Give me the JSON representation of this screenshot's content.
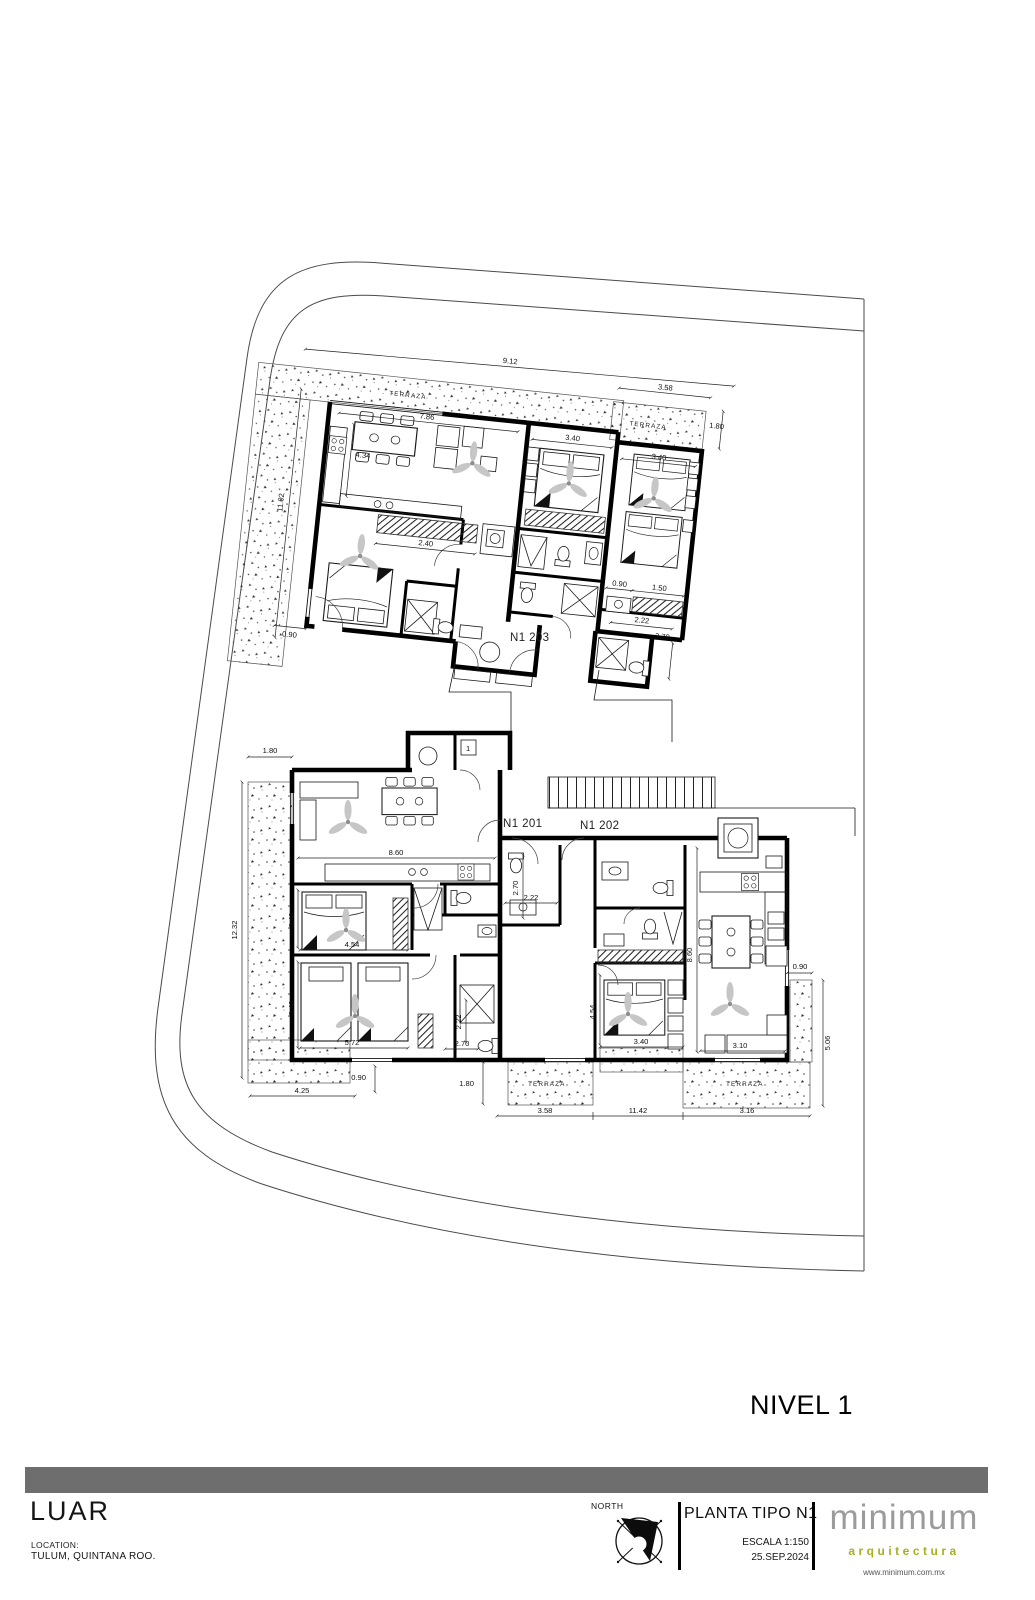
{
  "page": {
    "level_label": "NIVEL 1",
    "background": "#ffffff"
  },
  "plan": {
    "unit_labels": {
      "u201": "N1 201",
      "u202": "N1 202",
      "u203": "N1 203"
    },
    "terrace_label": "TERRAZA",
    "misc": {
      "tag": "1"
    },
    "dims": {
      "u203": {
        "total_w": "9.12",
        "living_w": "7.86",
        "kitchen_h": "4.34",
        "left_h": "11.02",
        "closet_w": "2.40",
        "door_w": "0.90",
        "bed_mid_w": "3.40",
        "bed_right_w": "3.40",
        "terrace_r_w": "3.58",
        "terrace_r_d": "1.80",
        "closet_a": "0.90",
        "closet_b": "1.50",
        "bath_w": "2.22",
        "bath_h": "2.70"
      },
      "u201": {
        "terrace_w": "1.80",
        "left_h": "12.32",
        "living_w": "8.60",
        "bed1_h": "3.40",
        "bed1_w": "4.54",
        "bed2_h": "3.40",
        "bed2_w": "5.72",
        "door_w": "0.90",
        "entry_w": "4.25",
        "bath_h": "2.22",
        "bath_w": "2.70"
      },
      "u202": {
        "bath_h": "2.70",
        "bath_w": "2.22",
        "depth": "8.60",
        "bed_h": "4.54",
        "bed_w": "3.40",
        "living_w": "3.10",
        "terrace_e_w": "0.90",
        "terrace_s_h": "5.06",
        "terrace_d": "1.80"
      },
      "site": {
        "chain_a": "3.58",
        "chain_b": "11.42",
        "chain_c": "3.16"
      }
    }
  },
  "titleblock": {
    "project": "LUAR",
    "location_label": "LOCATION:",
    "location_value": "TULUM, QUINTANA ROO.",
    "north_label": "NORTH",
    "sheet_title": "PLANTA TIPO N1",
    "scale": "ESCALA 1:150",
    "date": "25.SEP.2024",
    "bar_color": "#6e6e6e",
    "brand": {
      "name": "minimum",
      "tagline": "arquitectura",
      "website": "www.minimum.com.mx",
      "name_color": "#9b9b9b",
      "tagline_color": "#a6b021"
    }
  }
}
